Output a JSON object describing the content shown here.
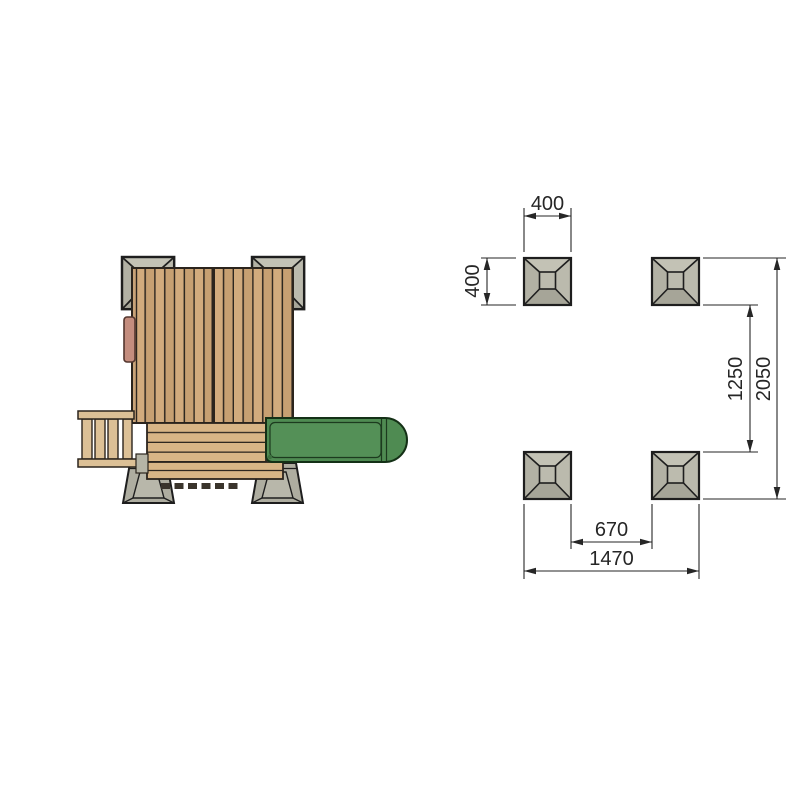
{
  "diagram": {
    "type": "technical-drawing",
    "plan_view": {
      "parts": [
        "concrete-footing-pad",
        "roof-planks",
        "door",
        "access-ladder",
        "deck-planks",
        "slide"
      ]
    },
    "foundation_layout": {
      "pad_count": 4,
      "dimensions": {
        "pad_width": "400",
        "pad_depth": "400",
        "pads_inner_gap_vertical": "1250",
        "overall_depth": "2050",
        "pads_inner_gap_horizontal": "670",
        "overall_width": "1470"
      }
    },
    "colors": {
      "background": "#ffffff",
      "concrete": "#b9b8ab",
      "concrete_shadow": "#a6a598",
      "wood_roof": "#cda77a",
      "wood_deck": "#d8b586",
      "slide_green": "#4f8b52",
      "outline": "#2b241d",
      "dimension_line": "#262626"
    }
  }
}
